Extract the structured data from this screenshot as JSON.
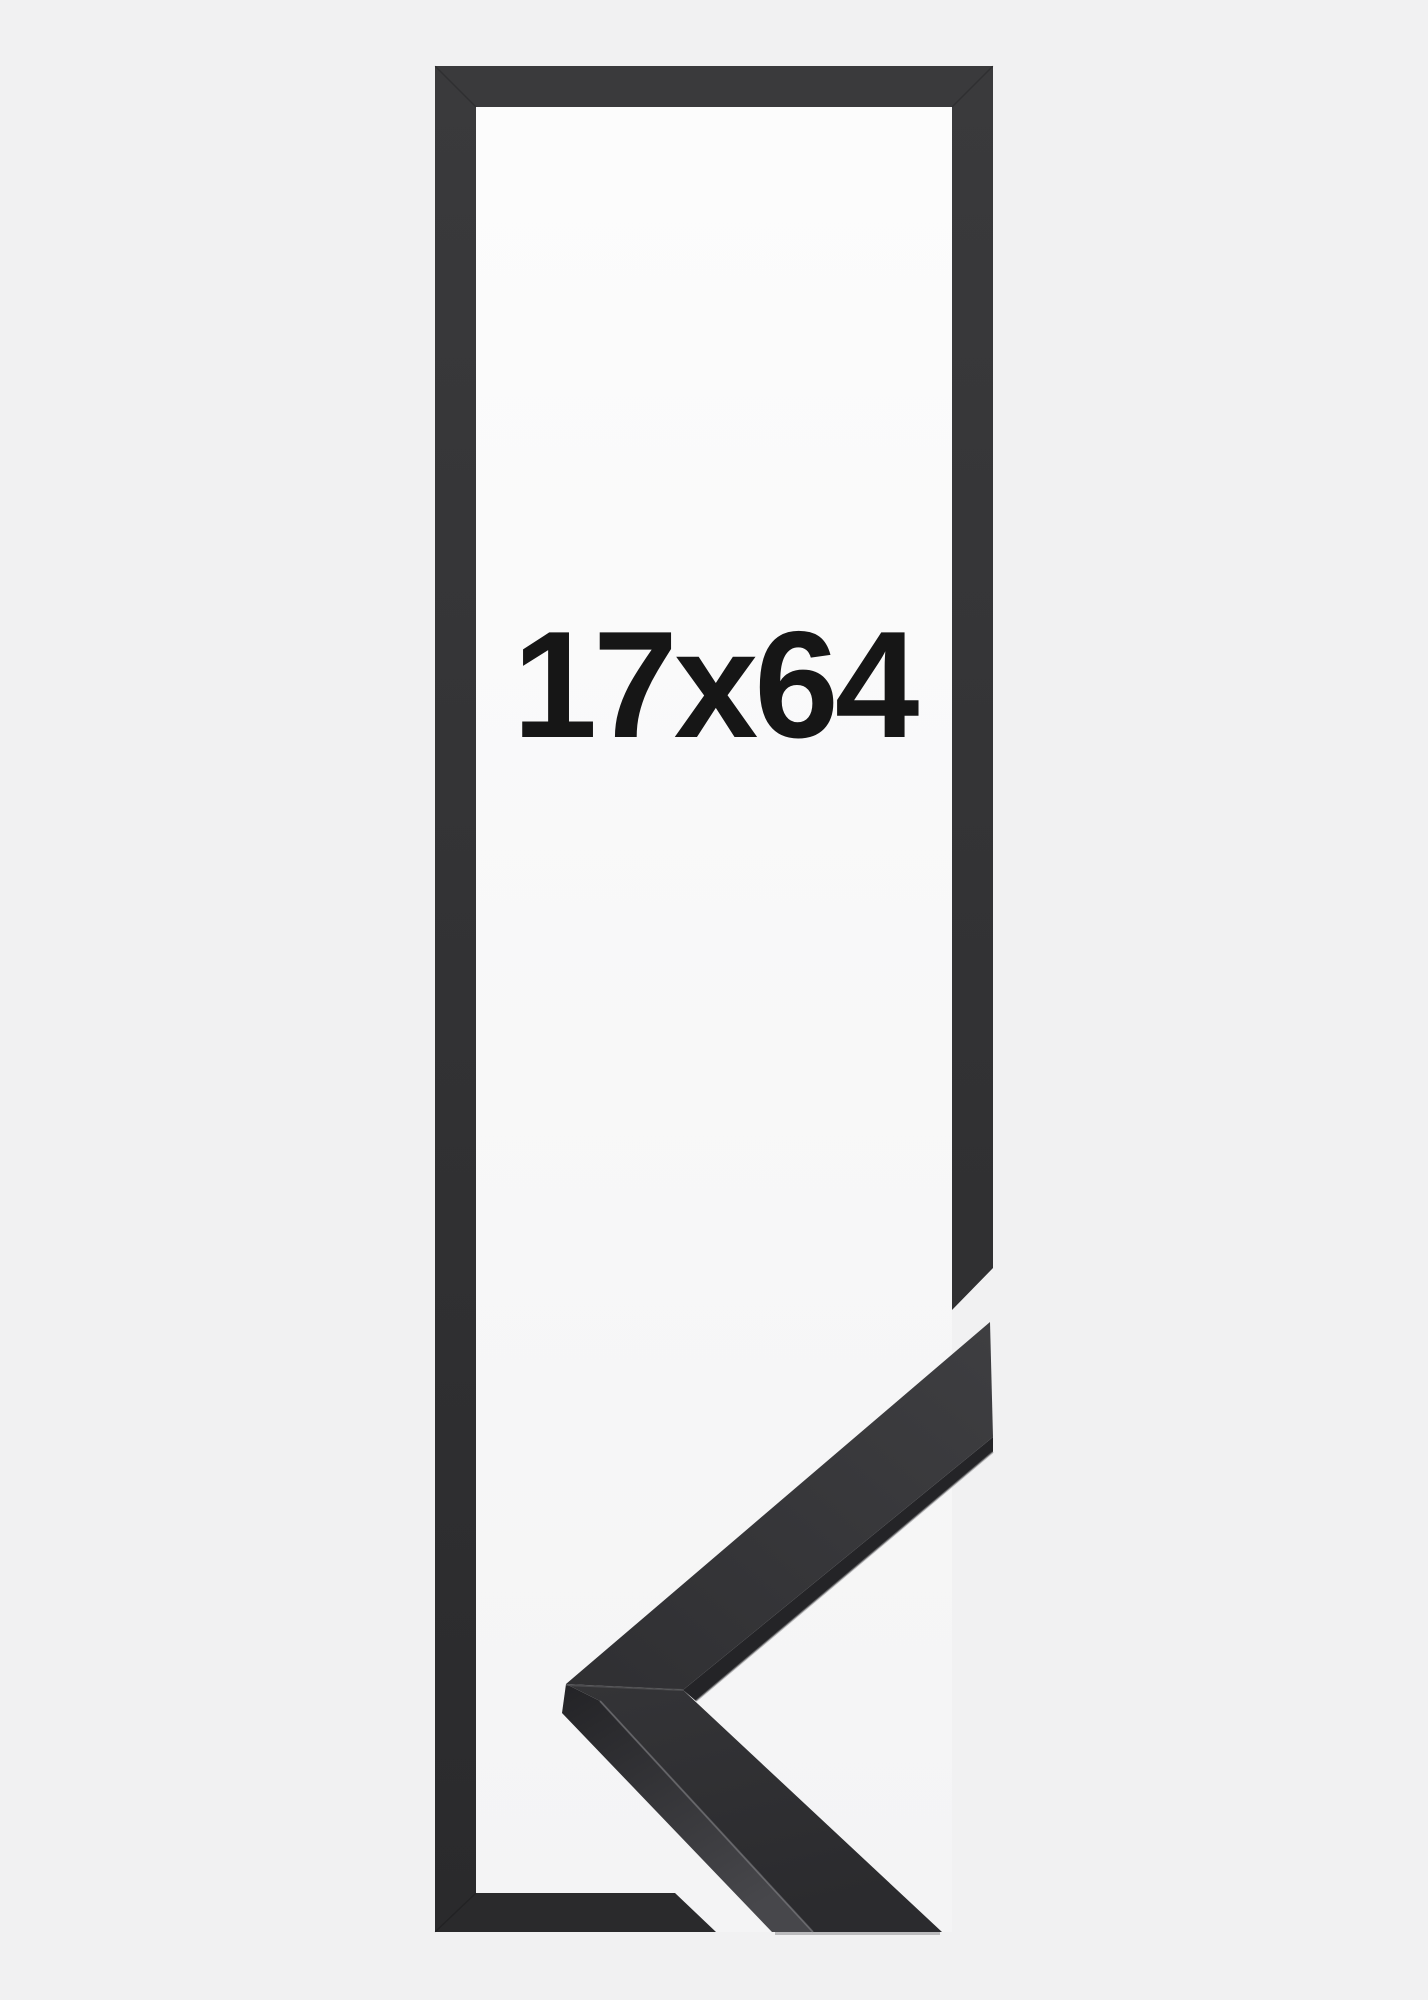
{
  "product_image": {
    "size_label": "17x64"
  },
  "colors": {
    "background": "#f1f1f2",
    "window_top": "#fcfcfc",
    "window_bottom": "#f4f4f5",
    "frame_top": "#3a3a3c",
    "frame_bottom": "#2a2a2c",
    "moulding_face_tip": "#3e3e41",
    "moulding_face_apex": "#2f2f32",
    "moulding_face_lower_top": "#343437",
    "moulding_face_lower_bottom": "#2b2b2e",
    "moulding_side_top": "#232326",
    "moulding_side_bottom": "#47474b",
    "moulding_edge_dark": "#242427",
    "highlight_edge": "#8a8a8d",
    "seam": "#6a6a6d",
    "ground_shadow": "#1c1c1e",
    "label_text": "#161616"
  }
}
